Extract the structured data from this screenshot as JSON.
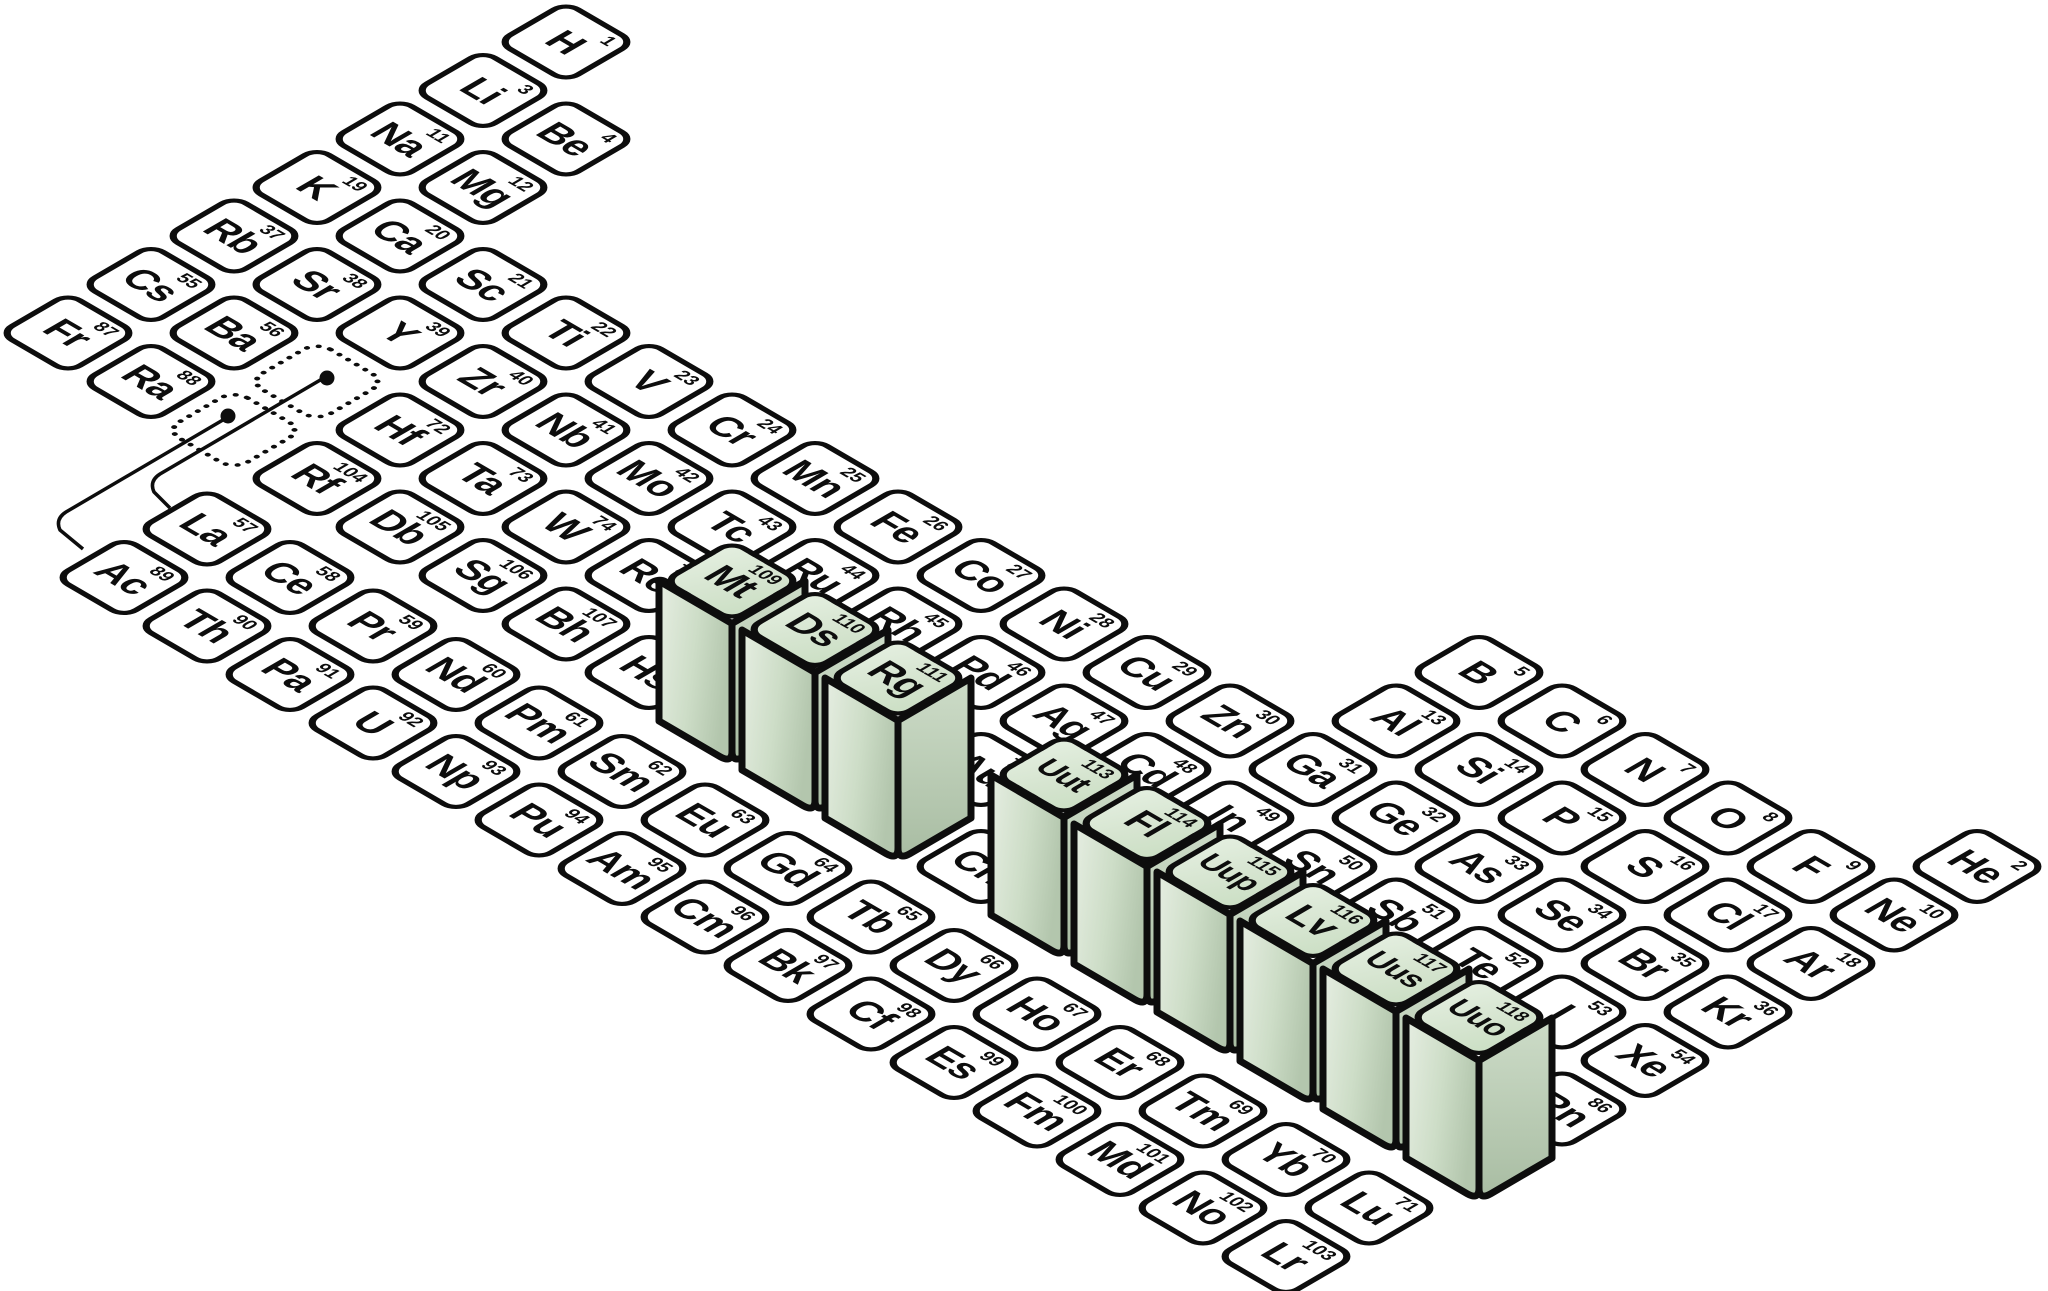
{
  "diagram": {
    "type": "isometric-periodic-table",
    "description_visible_text_only": true,
    "colors": {
      "background": "#ffffff",
      "tile_fill": "#ffffff",
      "outline": "#0d0d0d",
      "raised_top": "#d8e6d3",
      "raised_side_left_light": "#e6eee2",
      "raised_side_left_dark": "#b3c6ad",
      "raised_side_right_light": "#cddcc8",
      "raised_side_right_dark": "#a9bda3"
    }
  },
  "elements": [
    {
      "sym": "H",
      "num": 1,
      "group": 1,
      "period": 1
    },
    {
      "sym": "He",
      "num": 2,
      "group": 18,
      "period": 1
    },
    {
      "sym": "Li",
      "num": 3,
      "group": 1,
      "period": 2
    },
    {
      "sym": "Be",
      "num": 4,
      "group": 2,
      "period": 2
    },
    {
      "sym": "B",
      "num": 5,
      "group": 13,
      "period": 2
    },
    {
      "sym": "C",
      "num": 6,
      "group": 14,
      "period": 2
    },
    {
      "sym": "N",
      "num": 7,
      "group": 15,
      "period": 2
    },
    {
      "sym": "O",
      "num": 8,
      "group": 16,
      "period": 2
    },
    {
      "sym": "F",
      "num": 9,
      "group": 17,
      "period": 2
    },
    {
      "sym": "Ne",
      "num": 10,
      "group": 18,
      "period": 2
    },
    {
      "sym": "Na",
      "num": 11,
      "group": 1,
      "period": 3
    },
    {
      "sym": "Mg",
      "num": 12,
      "group": 2,
      "period": 3
    },
    {
      "sym": "Al",
      "num": 13,
      "group": 13,
      "period": 3
    },
    {
      "sym": "Si",
      "num": 14,
      "group": 14,
      "period": 3
    },
    {
      "sym": "P",
      "num": 15,
      "group": 15,
      "period": 3
    },
    {
      "sym": "S",
      "num": 16,
      "group": 16,
      "period": 3
    },
    {
      "sym": "Cl",
      "num": 17,
      "group": 17,
      "period": 3
    },
    {
      "sym": "Ar",
      "num": 18,
      "group": 18,
      "period": 3
    },
    {
      "sym": "K",
      "num": 19,
      "group": 1,
      "period": 4
    },
    {
      "sym": "Ca",
      "num": 20,
      "group": 2,
      "period": 4
    },
    {
      "sym": "Sc",
      "num": 21,
      "group": 3,
      "period": 4
    },
    {
      "sym": "Ti",
      "num": 22,
      "group": 4,
      "period": 4
    },
    {
      "sym": "V",
      "num": 23,
      "group": 5,
      "period": 4
    },
    {
      "sym": "Cr",
      "num": 24,
      "group": 6,
      "period": 4
    },
    {
      "sym": "Mn",
      "num": 25,
      "group": 7,
      "period": 4
    },
    {
      "sym": "Fe",
      "num": 26,
      "group": 8,
      "period": 4
    },
    {
      "sym": "Co",
      "num": 27,
      "group": 9,
      "period": 4
    },
    {
      "sym": "Ni",
      "num": 28,
      "group": 10,
      "period": 4
    },
    {
      "sym": "Cu",
      "num": 29,
      "group": 11,
      "period": 4
    },
    {
      "sym": "Zn",
      "num": 30,
      "group": 12,
      "period": 4
    },
    {
      "sym": "Ga",
      "num": 31,
      "group": 13,
      "period": 4
    },
    {
      "sym": "Ge",
      "num": 32,
      "group": 14,
      "period": 4
    },
    {
      "sym": "As",
      "num": 33,
      "group": 15,
      "period": 4
    },
    {
      "sym": "Se",
      "num": 34,
      "group": 16,
      "period": 4
    },
    {
      "sym": "Br",
      "num": 35,
      "group": 17,
      "period": 4
    },
    {
      "sym": "Kr",
      "num": 36,
      "group": 18,
      "period": 4
    },
    {
      "sym": "Rb",
      "num": 37,
      "group": 1,
      "period": 5
    },
    {
      "sym": "Sr",
      "num": 38,
      "group": 2,
      "period": 5
    },
    {
      "sym": "Y",
      "num": 39,
      "group": 3,
      "period": 5
    },
    {
      "sym": "Zr",
      "num": 40,
      "group": 4,
      "period": 5
    },
    {
      "sym": "Nb",
      "num": 41,
      "group": 5,
      "period": 5
    },
    {
      "sym": "Mo",
      "num": 42,
      "group": 6,
      "period": 5
    },
    {
      "sym": "Tc",
      "num": 43,
      "group": 7,
      "period": 5
    },
    {
      "sym": "Ru",
      "num": 44,
      "group": 8,
      "period": 5
    },
    {
      "sym": "Rh",
      "num": 45,
      "group": 9,
      "period": 5
    },
    {
      "sym": "Pd",
      "num": 46,
      "group": 10,
      "period": 5
    },
    {
      "sym": "Ag",
      "num": 47,
      "group": 11,
      "period": 5
    },
    {
      "sym": "Cd",
      "num": 48,
      "group": 12,
      "period": 5
    },
    {
      "sym": "In",
      "num": 49,
      "group": 13,
      "period": 5
    },
    {
      "sym": "Sn",
      "num": 50,
      "group": 14,
      "period": 5
    },
    {
      "sym": "Sb",
      "num": 51,
      "group": 15,
      "period": 5
    },
    {
      "sym": "Te",
      "num": 52,
      "group": 16,
      "period": 5
    },
    {
      "sym": "I",
      "num": 53,
      "group": 17,
      "period": 5
    },
    {
      "sym": "Xe",
      "num": 54,
      "group": 18,
      "period": 5
    },
    {
      "sym": "Cs",
      "num": 55,
      "group": 1,
      "period": 6
    },
    {
      "sym": "Ba",
      "num": 56,
      "group": 2,
      "period": 6
    },
    {
      "sym": "Hf",
      "num": 72,
      "group": 4,
      "period": 6
    },
    {
      "sym": "Ta",
      "num": 73,
      "group": 5,
      "period": 6
    },
    {
      "sym": "W",
      "num": 74,
      "group": 6,
      "period": 6
    },
    {
      "sym": "Re",
      "num": 75,
      "group": 7,
      "period": 6
    },
    {
      "sym": "Os",
      "num": 76,
      "group": 8,
      "period": 6
    },
    {
      "sym": "Ir",
      "num": 77,
      "group": 9,
      "period": 6
    },
    {
      "sym": "Pt",
      "num": 78,
      "group": 10,
      "period": 6
    },
    {
      "sym": "Au",
      "num": 79,
      "group": 11,
      "period": 6
    },
    {
      "sym": "Hg",
      "num": 80,
      "group": 12,
      "period": 6
    },
    {
      "sym": "Tl",
      "num": 81,
      "group": 13,
      "period": 6
    },
    {
      "sym": "Pb",
      "num": 82,
      "group": 14,
      "period": 6
    },
    {
      "sym": "Bi",
      "num": 83,
      "group": 15,
      "period": 6
    },
    {
      "sym": "Po",
      "num": 84,
      "group": 16,
      "period": 6
    },
    {
      "sym": "At",
      "num": 85,
      "group": 17,
      "period": 6
    },
    {
      "sym": "Rn",
      "num": 86,
      "group": 18,
      "period": 6
    },
    {
      "sym": "Fr",
      "num": 87,
      "group": 1,
      "period": 7
    },
    {
      "sym": "Ra",
      "num": 88,
      "group": 2,
      "period": 7
    },
    {
      "sym": "Rf",
      "num": 104,
      "group": 4,
      "period": 7
    },
    {
      "sym": "Db",
      "num": 105,
      "group": 5,
      "period": 7
    },
    {
      "sym": "Sg",
      "num": 106,
      "group": 6,
      "period": 7
    },
    {
      "sym": "Bh",
      "num": 107,
      "group": 7,
      "period": 7
    },
    {
      "sym": "Hs",
      "num": 108,
      "group": 8,
      "period": 7
    },
    {
      "sym": "Mt",
      "num": 109,
      "group": 9,
      "period": 7,
      "raised": true
    },
    {
      "sym": "Ds",
      "num": 110,
      "group": 10,
      "period": 7,
      "raised": true
    },
    {
      "sym": "Rg",
      "num": 111,
      "group": 11,
      "period": 7,
      "raised": true
    },
    {
      "sym": "Cn",
      "num": 112,
      "group": 12,
      "period": 7
    },
    {
      "sym": "Uut",
      "num": 113,
      "group": 13,
      "period": 7,
      "raised": true
    },
    {
      "sym": "Fl",
      "num": 114,
      "group": 14,
      "period": 7,
      "raised": true
    },
    {
      "sym": "Uup",
      "num": 115,
      "group": 15,
      "period": 7,
      "raised": true
    },
    {
      "sym": "Lv",
      "num": 116,
      "group": 16,
      "period": 7,
      "raised": true
    },
    {
      "sym": "Uus",
      "num": 117,
      "group": 17,
      "period": 7,
      "raised": true
    },
    {
      "sym": "Uuo",
      "num": 118,
      "group": 18,
      "period": 7,
      "raised": true
    }
  ],
  "lanthanides": [
    {
      "sym": "La",
      "num": 57
    },
    {
      "sym": "Ce",
      "num": 58
    },
    {
      "sym": "Pr",
      "num": 59
    },
    {
      "sym": "Nd",
      "num": 60
    },
    {
      "sym": "Pm",
      "num": 61
    },
    {
      "sym": "Sm",
      "num": 62
    },
    {
      "sym": "Eu",
      "num": 63
    },
    {
      "sym": "Gd",
      "num": 64
    },
    {
      "sym": "Tb",
      "num": 65
    },
    {
      "sym": "Dy",
      "num": 66
    },
    {
      "sym": "Ho",
      "num": 67
    },
    {
      "sym": "Er",
      "num": 68
    },
    {
      "sym": "Tm",
      "num": 69
    },
    {
      "sym": "Yb",
      "num": 70
    },
    {
      "sym": "Lu",
      "num": 71
    }
  ],
  "actinides": [
    {
      "sym": "Ac",
      "num": 89
    },
    {
      "sym": "Th",
      "num": 90
    },
    {
      "sym": "Pa",
      "num": 91
    },
    {
      "sym": "U",
      "num": 92
    },
    {
      "sym": "Np",
      "num": 93
    },
    {
      "sym": "Pu",
      "num": 94
    },
    {
      "sym": "Am",
      "num": 95
    },
    {
      "sym": "Cm",
      "num": 96
    },
    {
      "sym": "Bk",
      "num": 97
    },
    {
      "sym": "Cf",
      "num": 98
    },
    {
      "sym": "Es",
      "num": 99
    },
    {
      "sym": "Fm",
      "num": 100
    },
    {
      "sym": "Md",
      "num": 101
    },
    {
      "sym": "No",
      "num": 102
    },
    {
      "sym": "Lr",
      "num": 103
    }
  ],
  "placeholders": [
    {
      "name": "lanthanide-placeholder",
      "group": 3,
      "period": 6
    },
    {
      "name": "actinide-placeholder",
      "group": 3,
      "period": 7
    }
  ]
}
